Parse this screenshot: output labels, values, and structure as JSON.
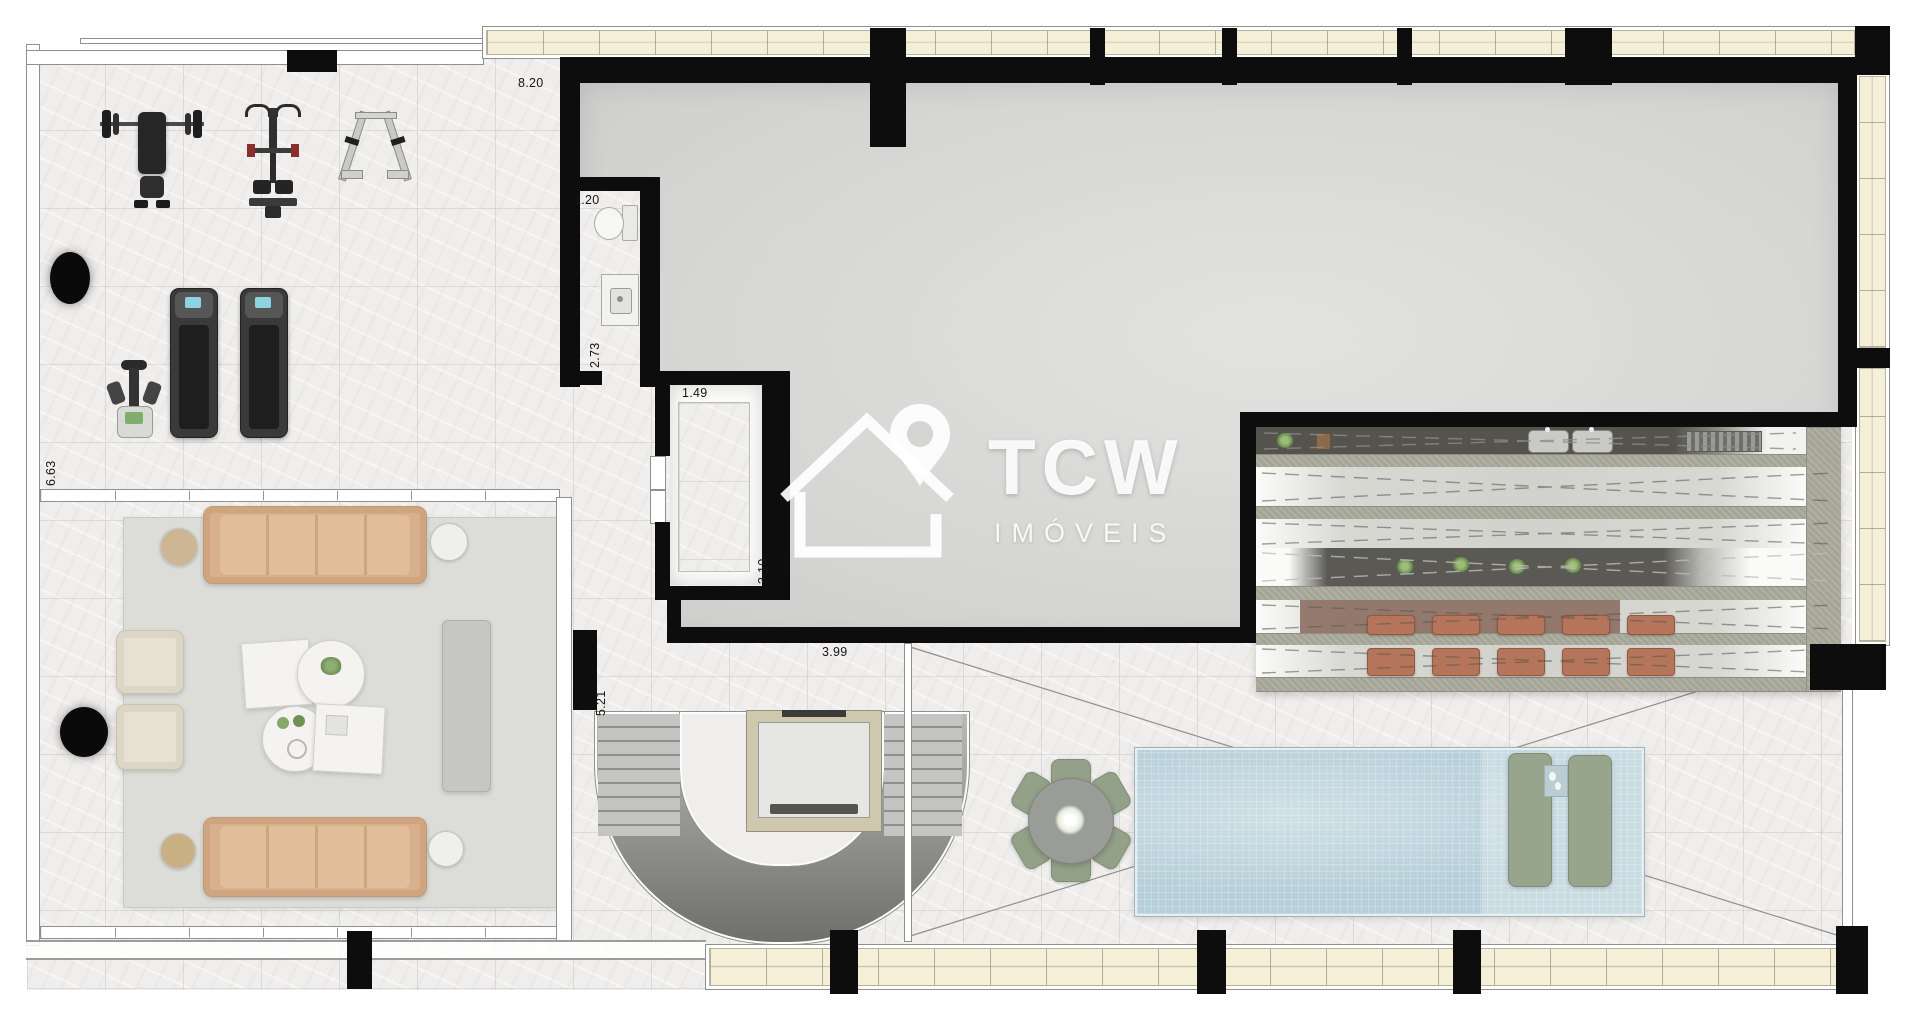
{
  "watermark": {
    "brand": "TCW",
    "subtitle": "IMÓVEIS"
  },
  "dimensions": {
    "hall_width": "8.20",
    "wc_width": "1.20",
    "wc_depth": "2.73",
    "store_width": "1.49",
    "store_depth": "3.10",
    "gym_depth": "6.63",
    "stair_depth": "5.21",
    "terrace_span": "3.99"
  },
  "palette": {
    "wall": "#0d0d0d",
    "window_glass_fill": "#f6efd7",
    "party_room_floor": "#d9d9d7",
    "marble_floor": "#efeeec",
    "pool_water": "#b6cfd9",
    "counter_stone": "#a5a597",
    "counter_dark": "#54534e",
    "stool_terracotta": "#b4755a",
    "sofa_tan": "#d8b08d",
    "chair_sage": "#93a189",
    "armchair_cream": "#e6e1d3"
  }
}
